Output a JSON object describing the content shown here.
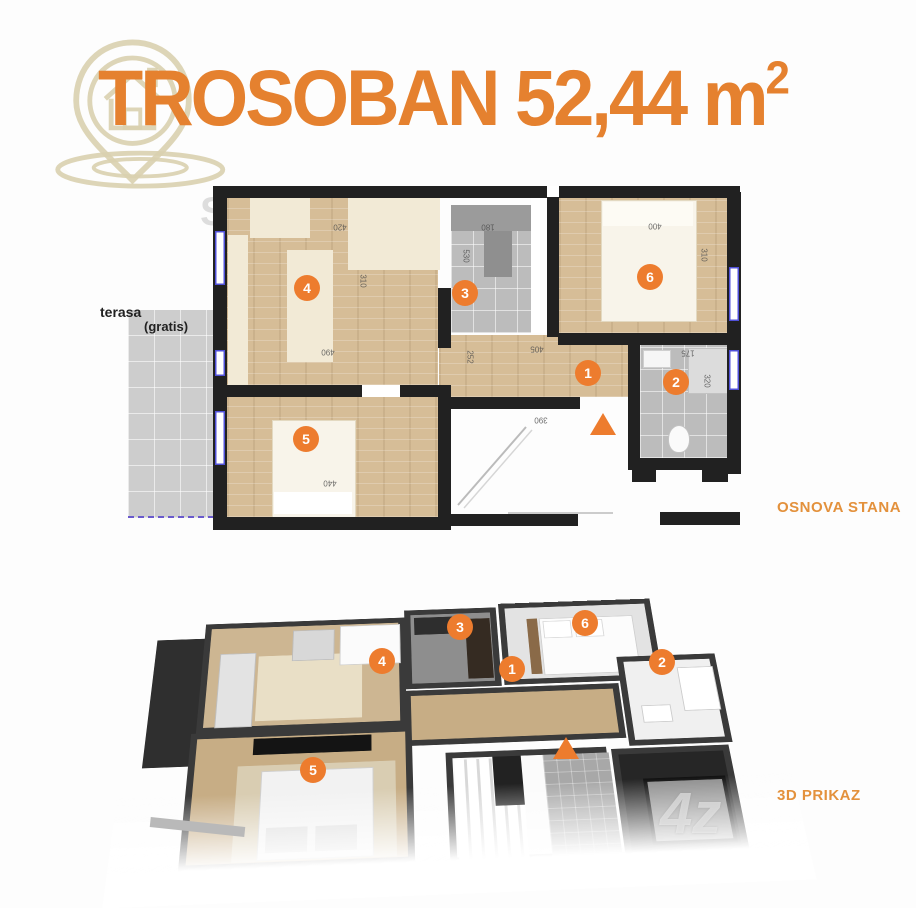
{
  "title": {
    "text": "TROSOBAN 52,44 m",
    "superscript": "2"
  },
  "colors": {
    "title_orange": "#E5812F",
    "marker_orange": "#ED7C2E",
    "label_orange": "#E3913C",
    "logo_beige": "#D9D0AF",
    "wall_dark": "#212121",
    "wood": "#D6BD97",
    "tile_gray": "#BCBCBC",
    "window_blue": "#5050D8"
  },
  "logo": {
    "icon": "house-location-pin-icon"
  },
  "watermarks": {
    "corner_letter": "S",
    "brand": "4z"
  },
  "plan2d": {
    "section_label": "OSNOVA STANA",
    "terrace_label_line1": "terasa",
    "terrace_label_line2": "(gratis)",
    "room_markers": [
      {
        "number": "1",
        "x": 588,
        "y": 373
      },
      {
        "number": "2",
        "x": 676,
        "y": 382
      },
      {
        "number": "3",
        "x": 465,
        "y": 293
      },
      {
        "number": "4",
        "x": 307,
        "y": 288
      },
      {
        "number": "5",
        "x": 306,
        "y": 439
      },
      {
        "number": "6",
        "x": 650,
        "y": 277
      }
    ],
    "entrance_arrow": {
      "x": 603,
      "y": 424
    },
    "dimension_labels": [
      {
        "text": "420",
        "x": 340,
        "y": 227,
        "rot": 180
      },
      {
        "text": "180",
        "x": 488,
        "y": 227,
        "rot": 180
      },
      {
        "text": "400",
        "x": 655,
        "y": 226,
        "rot": 180
      },
      {
        "text": "310",
        "x": 704,
        "y": 255,
        "rot": 90
      },
      {
        "text": "530",
        "x": 466,
        "y": 256,
        "rot": 90
      },
      {
        "text": "310",
        "x": 363,
        "y": 281,
        "rot": 90
      },
      {
        "text": "490",
        "x": 328,
        "y": 352,
        "rot": 180
      },
      {
        "text": "405",
        "x": 537,
        "y": 349,
        "rot": 180
      },
      {
        "text": "252",
        "x": 470,
        "y": 357,
        "rot": 90
      },
      {
        "text": "175",
        "x": 688,
        "y": 353,
        "rot": 180
      },
      {
        "text": "320",
        "x": 707,
        "y": 381,
        "rot": 90
      },
      {
        "text": "390",
        "x": 541,
        "y": 420,
        "rot": 180
      },
      {
        "text": "440",
        "x": 330,
        "y": 483,
        "rot": 180
      }
    ]
  },
  "plan3d": {
    "section_label": "3D PRIKAZ",
    "room_markers": [
      {
        "number": "1",
        "x": 512,
        "y": 669
      },
      {
        "number": "2",
        "x": 662,
        "y": 662
      },
      {
        "number": "3",
        "x": 460,
        "y": 627
      },
      {
        "number": "4",
        "x": 382,
        "y": 661
      },
      {
        "number": "5",
        "x": 313,
        "y": 770
      },
      {
        "number": "6",
        "x": 585,
        "y": 623
      }
    ],
    "entrance_arrow": {
      "x": 566,
      "y": 748
    }
  }
}
